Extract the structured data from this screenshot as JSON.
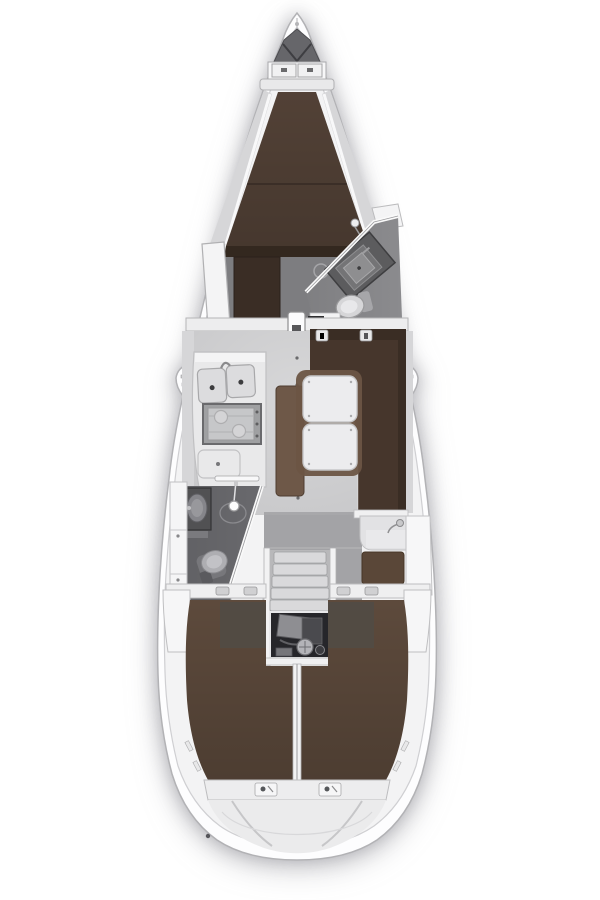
{
  "title": "sailboat-interior-floor-plan",
  "palette": {
    "page_bg": "#ffffff",
    "hull_fill": "#fdfdfe",
    "hull_stroke": "#b2b2b5",
    "deck_fill": "#f3f3f4",
    "deck_stroke": "#cfcfd2",
    "wall_white": "#f7f7f8",
    "wall_stroke": "#a9a9ac",
    "wedge_gray": "#d6d6d8",
    "floor_light": "#c7c7c9",
    "floor_mid": "#a3a3a6",
    "floor_dark": "#7d7d80",
    "head_floor": "#69696d",
    "anchor_gray": "#66666a",
    "vberth_brown": "#524136",
    "foot_dark": "#33281f",
    "settee_brown": "#46362c",
    "bench_brown": "#6e5848",
    "aft_berth_brown": "#5d4a3c",
    "patch_gray": "#514b45",
    "nav_seat_brown": "#5a4738",
    "wood_dark": "#3a2d25",
    "table_white": "#ececee",
    "fixture_light": "#d9d9db",
    "fixture_mid": "#a9a9ac",
    "vanity_dark": "#515153",
    "porcelain": "#d6d6d8",
    "engine_dark": "#26262a",
    "steel_gray": "#8e8e92"
  },
  "areas": [
    {
      "id": "anchor-locker"
    },
    {
      "id": "v-berth"
    },
    {
      "id": "forward-head"
    },
    {
      "id": "mast-post"
    },
    {
      "id": "galley"
    },
    {
      "id": "salon-table"
    },
    {
      "id": "starboard-settee"
    },
    {
      "id": "port-bench"
    },
    {
      "id": "aft-head"
    },
    {
      "id": "nav-station"
    },
    {
      "id": "companionway-steps"
    },
    {
      "id": "engine-compartment"
    },
    {
      "id": "port-aft-berth"
    },
    {
      "id": "starboard-aft-berth"
    },
    {
      "id": "transom"
    }
  ]
}
